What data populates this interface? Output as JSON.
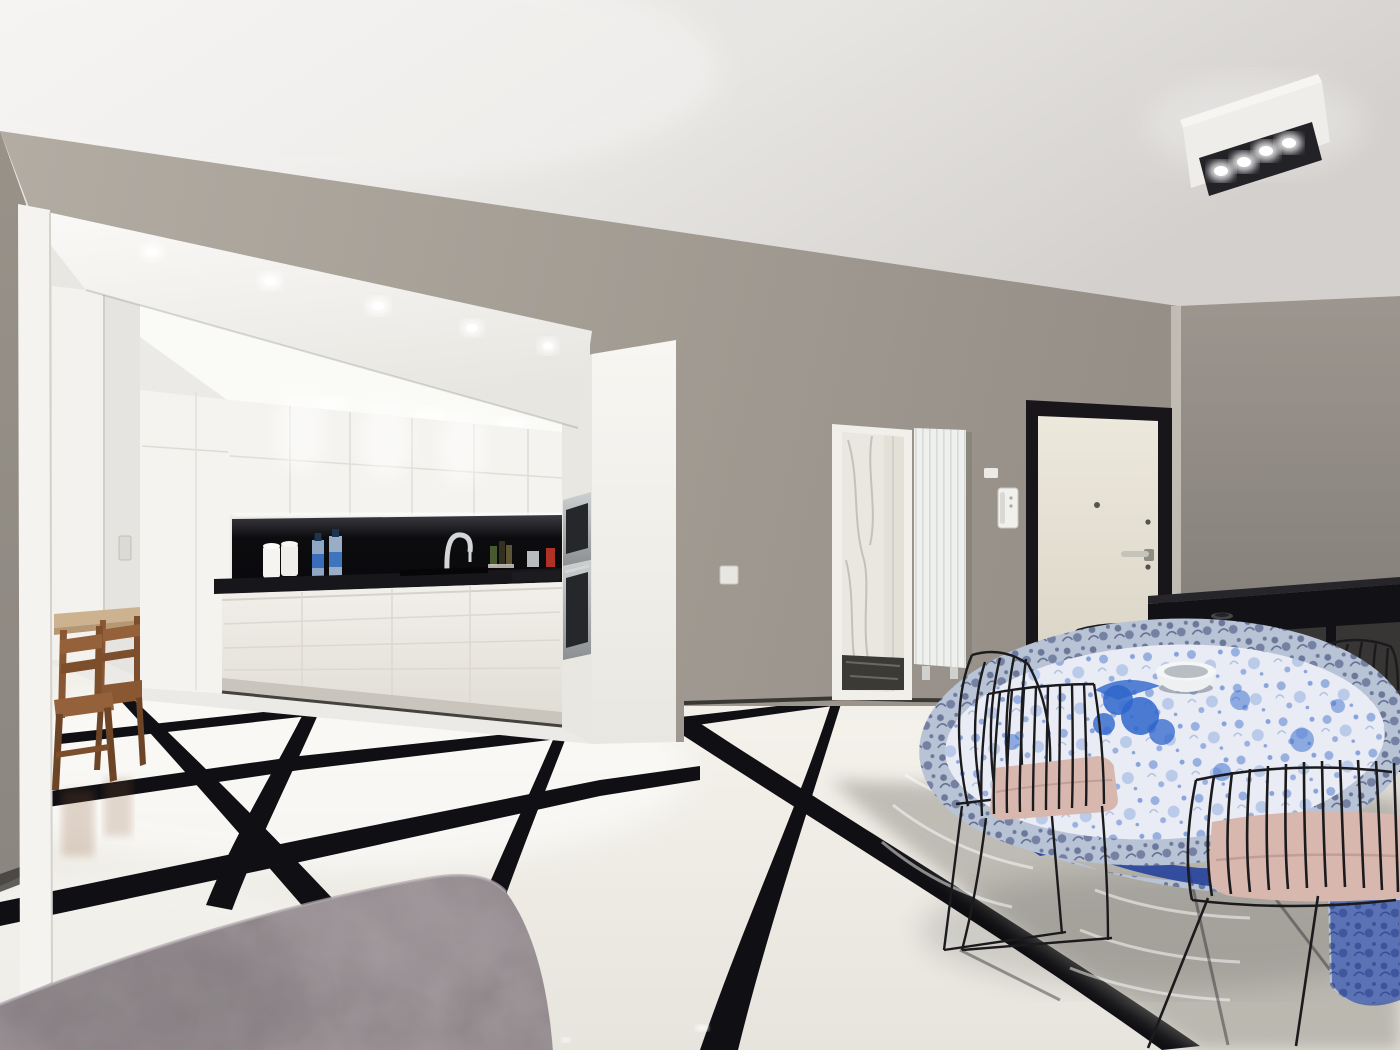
{
  "scene": {
    "type": "interior-photograph",
    "description": "Modern apartment: white kitchen in a lit alcove, glossy white floor tiles with black strips, dining table with blue patterned tablecloth, black wire chairs, entrance door, radiator, black sideboard, grey suede ottoman in foreground",
    "colors": {
      "ceiling": "#e7e5e2",
      "wall": "#a49e95",
      "wall_light": "#b2aca3",
      "wall_right": "#948e87",
      "wall_left_column": "#8b8680",
      "soffit": "#f6f5f1",
      "alcove_interior": "#eceae6",
      "cabinet": "#f4f3ef",
      "cabinet_shadow": "#e2dfd9",
      "backsplash": "#0c0c0f",
      "countertop": "#17171b",
      "led_strip": "#ffffff",
      "steel": "#b9bcbe",
      "appliance_glass": "#26272b",
      "floor": "#f3f1ea",
      "floor_strip": "#101014",
      "floor_shadow": "#8f8c84",
      "marble": "#eae7e1",
      "marble_vein": "#b5b1a9",
      "radiator": "#eef0ee",
      "door_leaf": "#e8e4d8",
      "door_frame": "#18161b",
      "handle": "#c6c3ba",
      "intercom": "#f1f0ed",
      "sideboard": "#121115",
      "sideboard_panel": "#3c3b37",
      "tablecloth_base": "#e9ecf4",
      "tablecloth_blue": "#3767c8",
      "tablecloth_navy": "#1d3c9c",
      "tablecloth_rim": "#b9c3d6",
      "cushion": "#d8b7ae",
      "chair_wire": "#1b1b1e",
      "wood": "#8a5733",
      "wood_dark": "#6d4425",
      "wood_table_top": "#cdb28f",
      "ottoman": "#8e8589",
      "ottoman_light": "#a79ea3",
      "bowl": "#eef0f2",
      "glow": "#ffffff"
    },
    "objects": [
      "ceiling",
      "ceiling-light-fixture",
      "kitchen-alcove",
      "white-kitchen-cabinets",
      "black-backsplash",
      "led-strip",
      "faucet",
      "water-bottles",
      "paper-towel-rolls",
      "built-in-microwave",
      "built-in-oven",
      "corridor",
      "wooden-side-table",
      "wooden-chairs",
      "bathroom-doorway",
      "marble-wall",
      "vertical-radiator",
      "intercom",
      "light-switch",
      "entrance-door",
      "door-handle",
      "black-sideboard",
      "dining-table",
      "blue-tablecloth",
      "white-bowl",
      "black-wire-chairs",
      "pink-seat-cushions",
      "glossy-tiled-floor",
      "black-floor-strips",
      "grey-ottoman"
    ]
  }
}
